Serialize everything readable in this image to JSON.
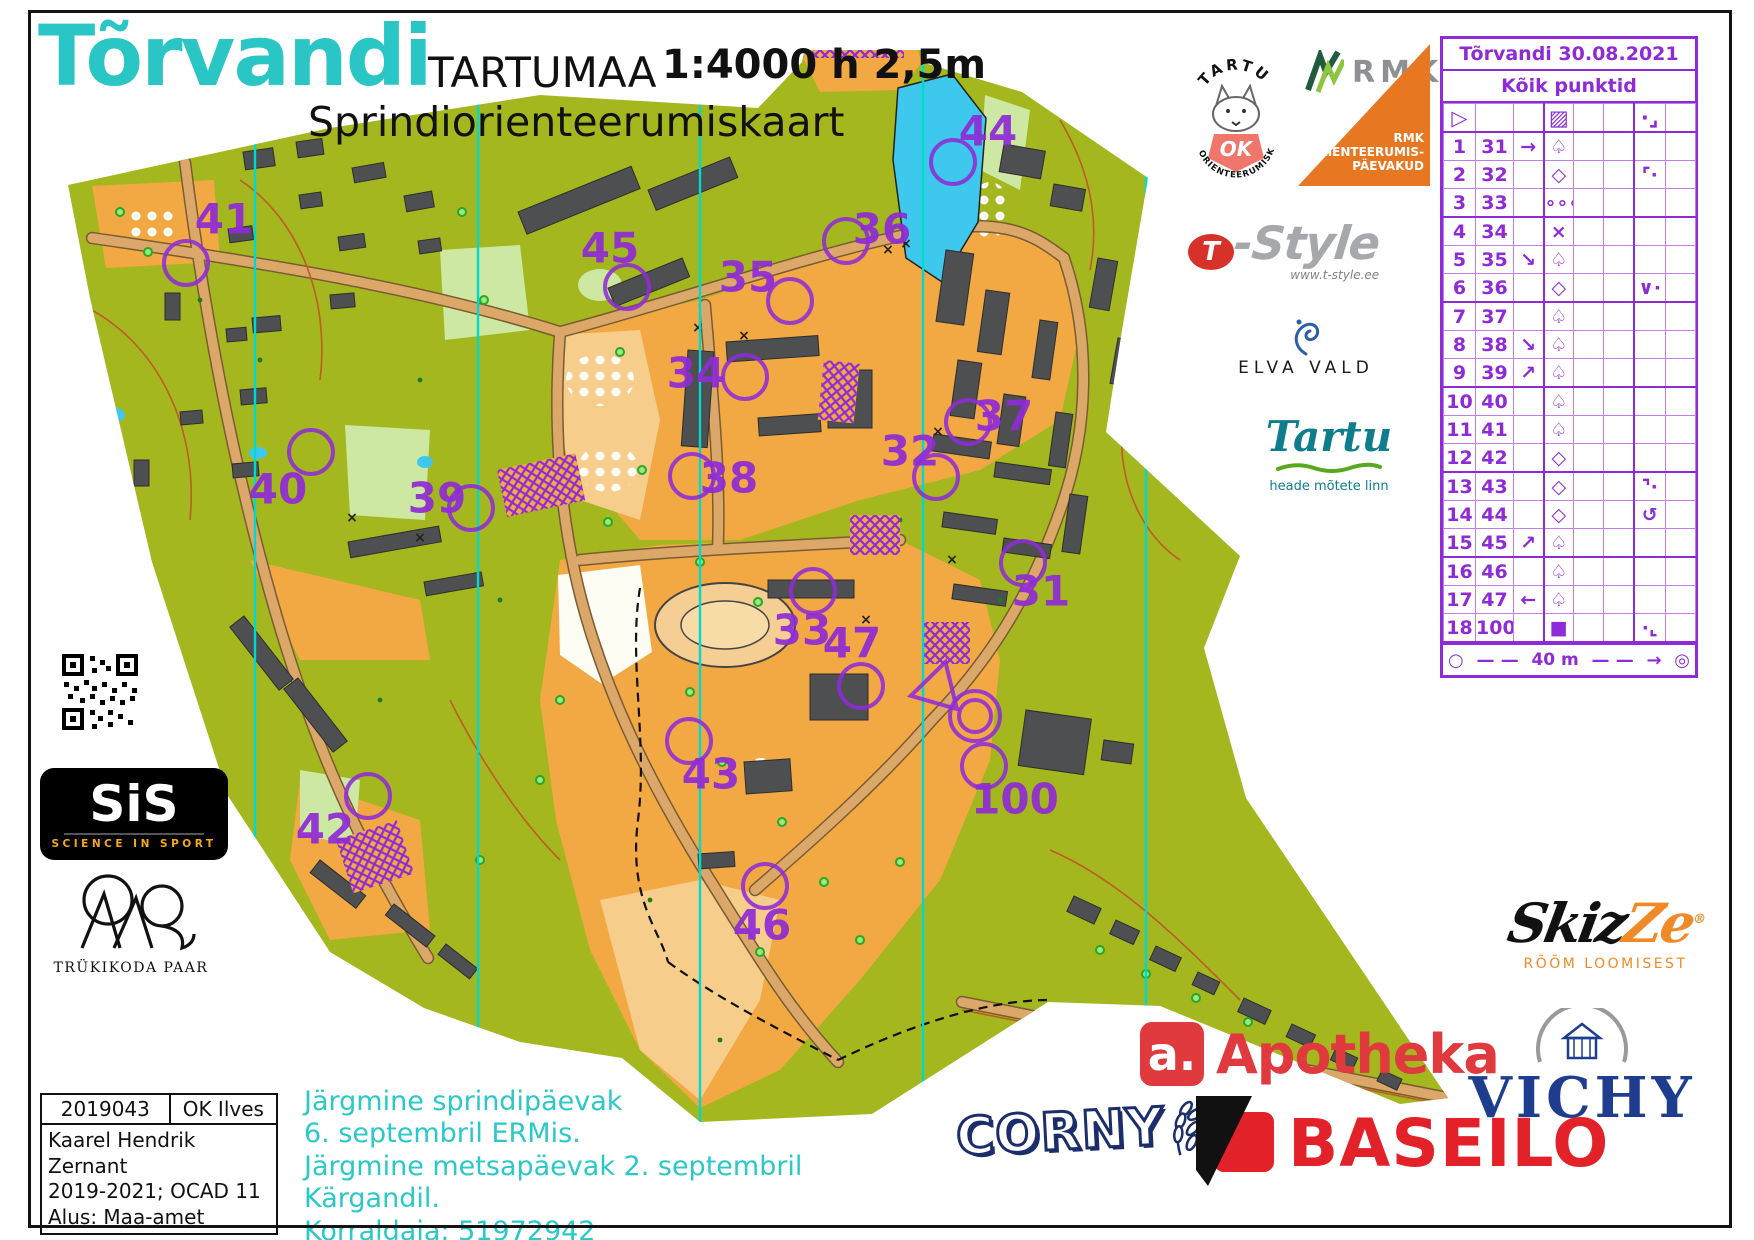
{
  "page": {
    "title": "Tõrvandi",
    "region": "TARTUMAA",
    "scale": "1:4000 h 2,5m",
    "subtitle": "Sprindiorienteerumiskaart"
  },
  "colors": {
    "accent_teal": "#2AC6C6",
    "overprint_purple": "#8F2BD6",
    "map_green": "#A4B71E",
    "map_orange": "#F2A843",
    "map_sand": "#F6CD8B",
    "building_gray": "#4E4F50",
    "water_blue": "#3EC8EE",
    "north_line_cyan": "#00D9CF"
  },
  "control_sheet": {
    "title": "Tõrvandi 30.08.2021",
    "subtitle": "Kõik punktid",
    "symbol_row": {
      "a": "▷",
      "b": "",
      "c": "",
      "d": "▨",
      "e": "",
      "f": "",
      "g": "·⌟",
      "h": ""
    },
    "rows": [
      {
        "no": "1",
        "code": "31",
        "c": "→",
        "d": "♤",
        "e": "",
        "f": "",
        "g": "",
        "h": ""
      },
      {
        "no": "2",
        "code": "32",
        "c": "",
        "d": "◇",
        "e": "",
        "f": "",
        "g": "⌜·",
        "h": ""
      },
      {
        "no": "3",
        "code": "33",
        "c": "",
        "d": "∘∘∘",
        "e": "",
        "f": "",
        "g": "",
        "h": ""
      },
      {
        "no": "4",
        "code": "34",
        "c": "",
        "d": "×",
        "e": "",
        "f": "",
        "g": "",
        "h": ""
      },
      {
        "no": "5",
        "code": "35",
        "c": "↘",
        "d": "♤",
        "e": "",
        "f": "",
        "g": "",
        "h": ""
      },
      {
        "no": "6",
        "code": "36",
        "c": "",
        "d": "◇",
        "e": "",
        "f": "",
        "g": "∨·",
        "h": ""
      },
      {
        "no": "7",
        "code": "37",
        "c": "",
        "d": "♤",
        "e": "",
        "f": "",
        "g": "",
        "h": ""
      },
      {
        "no": "8",
        "code": "38",
        "c": "↘",
        "d": "♤",
        "e": "",
        "f": "",
        "g": "",
        "h": ""
      },
      {
        "no": "9",
        "code": "39",
        "c": "↗",
        "d": "♤",
        "e": "",
        "f": "",
        "g": "",
        "h": ""
      },
      {
        "no": "10",
        "code": "40",
        "c": "",
        "d": "♤",
        "e": "",
        "f": "",
        "g": "",
        "h": ""
      },
      {
        "no": "11",
        "code": "41",
        "c": "",
        "d": "♤",
        "e": "",
        "f": "",
        "g": "",
        "h": ""
      },
      {
        "no": "12",
        "code": "42",
        "c": "",
        "d": "◇",
        "e": "",
        "f": "",
        "g": "",
        "h": ""
      },
      {
        "no": "13",
        "code": "43",
        "c": "",
        "d": "◇",
        "e": "",
        "f": "",
        "g": "⌝·",
        "h": ""
      },
      {
        "no": "14",
        "code": "44",
        "c": "",
        "d": "◇",
        "e": "",
        "f": "",
        "g": "↺",
        "h": ""
      },
      {
        "no": "15",
        "code": "45",
        "c": "↗",
        "d": "♤",
        "e": "",
        "f": "",
        "g": "",
        "h": ""
      },
      {
        "no": "16",
        "code": "46",
        "c": "",
        "d": "♤",
        "e": "",
        "f": "",
        "g": "",
        "h": ""
      },
      {
        "no": "17",
        "code": "47",
        "c": "←",
        "d": "♤",
        "e": "",
        "f": "",
        "g": "",
        "h": ""
      },
      {
        "no": "18",
        "code": "100",
        "c": "",
        "d": "■",
        "e": "",
        "f": "",
        "g": "·⌞",
        "h": ""
      }
    ],
    "finish_row": {
      "start": "○",
      "dash1": "— —",
      "distance": "40 m",
      "dash2": "— —",
      "arrow": "→",
      "end": "◎"
    }
  },
  "map": {
    "north_line_xs": [
      255,
      478,
      700,
      923,
      1146
    ],
    "start": {
      "x": 938,
      "y": 688
    },
    "finish": {
      "x": 975,
      "y": 716
    },
    "controls": [
      {
        "id": "41",
        "cx": 186,
        "cy": 263,
        "lx": 224,
        "ly": 219
      },
      {
        "id": "44",
        "cx": 953,
        "cy": 162,
        "lx": 988,
        "ly": 131
      },
      {
        "id": "45",
        "cx": 627,
        "cy": 287,
        "lx": 610,
        "ly": 248
      },
      {
        "id": "36",
        "cx": 846,
        "cy": 241,
        "lx": 882,
        "ly": 229
      },
      {
        "id": "35",
        "cx": 790,
        "cy": 301,
        "lx": 748,
        "ly": 277
      },
      {
        "id": "34",
        "cx": 745,
        "cy": 377,
        "lx": 696,
        "ly": 373
      },
      {
        "id": "37",
        "cx": 968,
        "cy": 422,
        "lx": 1004,
        "ly": 416
      },
      {
        "id": "32",
        "cx": 936,
        "cy": 477,
        "lx": 910,
        "ly": 451
      },
      {
        "id": "38",
        "cx": 692,
        "cy": 476,
        "lx": 729,
        "ly": 478
      },
      {
        "id": "40",
        "cx": 311,
        "cy": 452,
        "lx": 278,
        "ly": 489
      },
      {
        "id": "39",
        "cx": 471,
        "cy": 508,
        "lx": 437,
        "ly": 498
      },
      {
        "id": "31",
        "cx": 1023,
        "cy": 563,
        "lx": 1041,
        "ly": 591
      },
      {
        "id": "33",
        "cx": 813,
        "cy": 591,
        "lx": 802,
        "ly": 630
      },
      {
        "id": "47",
        "cx": 861,
        "cy": 686,
        "lx": 852,
        "ly": 643
      },
      {
        "id": "43",
        "cx": 689,
        "cy": 741,
        "lx": 711,
        "ly": 774
      },
      {
        "id": "42",
        "cx": 368,
        "cy": 796,
        "lx": 325,
        "ly": 829
      },
      {
        "id": "100",
        "cx": 984,
        "cy": 766,
        "lx": 1015,
        "ly": 799
      },
      {
        "id": "46",
        "cx": 765,
        "cy": 886,
        "lx": 762,
        "ly": 925
      }
    ]
  },
  "logos": {
    "ok_tartu": {
      "top": "TARTU",
      "monogram": "OK",
      "bottom": "ORIENTEERUMISKLUBI"
    },
    "rmk": {
      "name": "RMK"
    },
    "rmk_paevakud": {
      "line1": "RMK",
      "line2": "ORIENTEERUMIS-",
      "line3": "PÄEVAKUD"
    },
    "tstyle": {
      "t": "T",
      "name": "-Style",
      "url": "www.t-style.ee"
    },
    "elva": {
      "name": "ELVA VALD"
    },
    "tartu_city": {
      "name": "Tartu",
      "tagline": "heade mõtete linn"
    },
    "sis": {
      "name": "SiS",
      "tagline": "SCIENCE IN SPORT"
    },
    "paar": {
      "name": "TRÜKIKODA PAAR"
    },
    "skizze": {
      "part1": "Skiz",
      "part2": "Ze",
      "reg": "®",
      "tagline": "RÕÕM LOOMISEST"
    },
    "apotheka": {
      "a": "a.",
      "name": "Apotheka"
    },
    "vichy": {
      "name": "VICHY"
    },
    "corny": {
      "name": "CORNY"
    },
    "baseilo": {
      "name": "BASEILO"
    }
  },
  "footer": {
    "info_box": {
      "code": "2019043",
      "club": "OK Ilves",
      "lines": [
        "Kaarel Hendrik Zernant",
        "2019-2021; OCAD 11",
        "Alus: Maa-amet"
      ]
    },
    "announcement": [
      "Järgmine sprindipäevak",
      "6. septembril ERMis.",
      "Järgmine metsapäevak 2. septembril",
      "Kärgandil.",
      "Korraldaja: 51972942"
    ]
  }
}
